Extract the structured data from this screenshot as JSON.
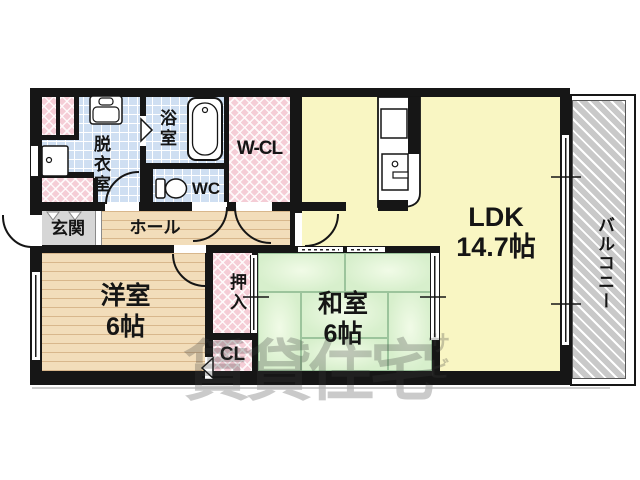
{
  "plan": {
    "rooms": {
      "ldk": {
        "label": "LDK",
        "size": "14.7帖"
      },
      "washitsu": {
        "label": "和室",
        "size": "6帖"
      },
      "youshitsu": {
        "label": "洋室",
        "size": "6帖"
      },
      "oshiire": {
        "label": "押入"
      },
      "closet": {
        "label": "CL"
      },
      "wcl": {
        "label": "W-CL"
      },
      "wc": {
        "label": "WC"
      },
      "bathroom": {
        "label": "浴室"
      },
      "dressing": {
        "label": "脱衣室"
      },
      "entrance": {
        "label": "玄関"
      },
      "hall": {
        "label": "ホール"
      },
      "balcony": {
        "label": "バルコニー"
      }
    },
    "watermark": {
      "main": "賃貸住宅",
      "side_top": "サ",
      "side_bottom": "ビ"
    },
    "colors": {
      "wall": "#161616",
      "ldk_floor": "#f9f6c3",
      "tatami_floor": "#d9f0cf",
      "wood_floor": "#f2ddba",
      "tile_floor": "#cfdff2",
      "closet_pink": "#f5cdd6",
      "entrance_gray": "#d6d6d6",
      "balcony_gray": "#c9c9c9"
    }
  }
}
